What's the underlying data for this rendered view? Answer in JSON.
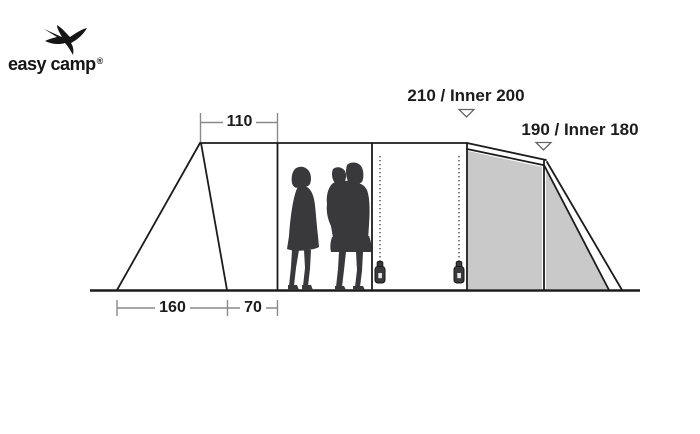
{
  "logo": {
    "brand": "easy camp",
    "registered": "®"
  },
  "diagram": {
    "dimensions": {
      "top_width": "110",
      "ground_left_width": "160",
      "ground_right_width": "70",
      "center_height": "210 / Inner 200",
      "rear_height": "190 / Inner 180"
    },
    "colors": {
      "background": "#ffffff",
      "outline": "#1c1c1c",
      "dimension_line": "#8a8a8a",
      "shaded_panel": "#c9c9ca",
      "silhouette": "#39393b",
      "arrow_fill": "#ffffff",
      "arrow_stroke": "#666666"
    },
    "icons": [
      "swallow-icon",
      "zipper-pull-icon",
      "down-arrow-icon",
      "people-silhouette"
    ]
  }
}
